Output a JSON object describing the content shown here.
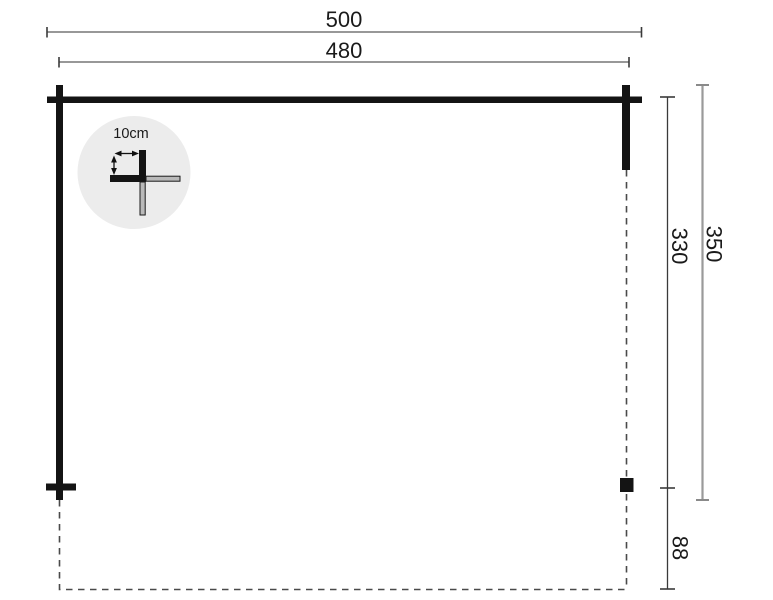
{
  "page": {
    "type": "dimensioned floor plan drawing",
    "background": "#ffffff"
  },
  "dimensions": {
    "width_outer": "500",
    "width_inner": "480",
    "depth_inner": "330",
    "depth_outer": "350",
    "rear_overhang": "88"
  },
  "detail": {
    "beam_size_label": "10cm"
  },
  "colors": {
    "structure": "#141414",
    "dimension_line_gray": "#8a8a8a",
    "dimension_line_dark": "#3a3a3a",
    "dashed_outline": "#4a4a4a",
    "detail_circle_fill": "#ececec",
    "detail_beam_fill": "#b9b9b9",
    "text": "#1a1a1a"
  }
}
